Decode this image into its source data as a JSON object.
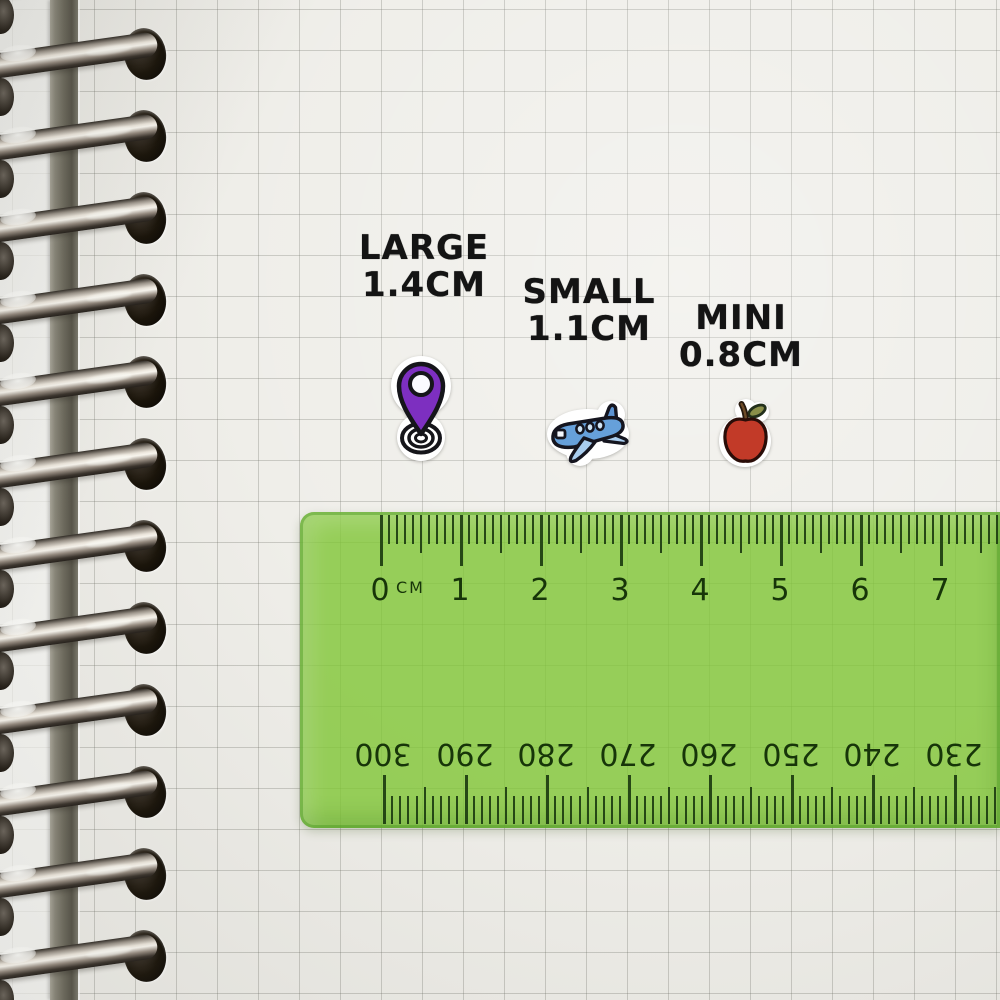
{
  "scene": {
    "description": "Spiral notebook grid page with three sticker size samples and a green transparent ruler"
  },
  "labels": {
    "large": {
      "name": "LARGE",
      "size": "1.4CM"
    },
    "small": {
      "name": "SMALL",
      "size": "1.1CM"
    },
    "mini": {
      "name": "MINI",
      "size": "0.8CM"
    }
  },
  "stickers": [
    {
      "name": "location-pin-sticker",
      "size_label": "LARGE",
      "size_cm": "1.4CM",
      "color": "#7d2fc0"
    },
    {
      "name": "airplane-sticker",
      "size_label": "SMALL",
      "size_cm": "1.1CM",
      "color": "#66a0da"
    },
    {
      "name": "apple-sticker",
      "size_label": "MINI",
      "size_cm": "0.8CM",
      "color": "#c23a28"
    }
  ],
  "ruler": {
    "unit_label": "CM",
    "top_numbers": [
      "0",
      "1",
      "2",
      "3",
      "4",
      "5",
      "6",
      "7"
    ],
    "bottom_numbers": [
      "300",
      "290",
      "280",
      "270",
      "260",
      "250",
      "240",
      "230"
    ],
    "body_color": "#80c634",
    "tick_color": "#1c3c10"
  },
  "binding": {
    "ring_count": 13
  }
}
